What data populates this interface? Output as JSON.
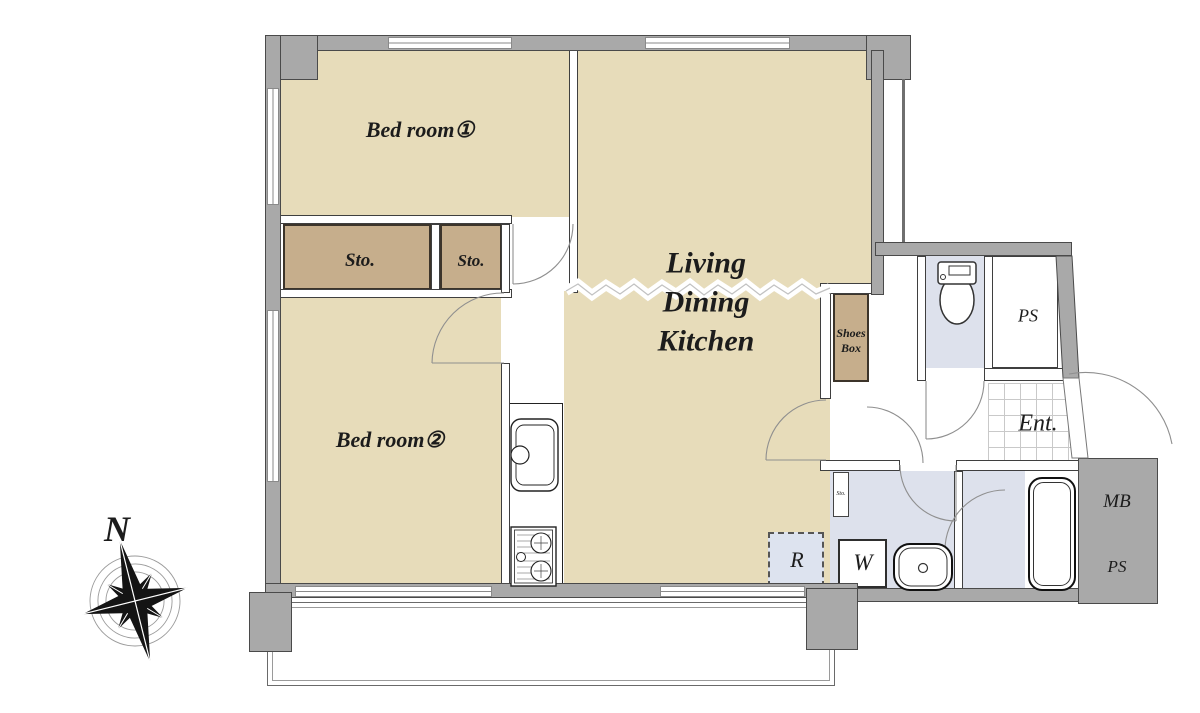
{
  "title": "Apartment floor plan (2LDK)",
  "rooms": {
    "bedroom1": {
      "label": "Bed room①"
    },
    "bedroom2": {
      "label": "Bed room②"
    },
    "ldk": {
      "lines": [
        "Living",
        "Dining",
        "Kitchen"
      ]
    },
    "storage_large": {
      "label": "Sto."
    },
    "storage_small": {
      "label": "Sto."
    },
    "shoes_box": {
      "lines": [
        "Shoes",
        "Box"
      ]
    },
    "ps_top": {
      "label": "PS"
    },
    "entrance": {
      "label": "Ent."
    },
    "meter_box": {
      "label": "MB"
    },
    "ps_bottom": {
      "label": "PS"
    },
    "refrigerator": {
      "label": "R"
    },
    "washing_machine": {
      "label": "W"
    },
    "washroom_storage": {
      "label": "Sto."
    }
  },
  "compass": {
    "north_label": "N"
  },
  "colors": {
    "room_fill": "#e7dcba",
    "closet_fill": "#c6ae8c",
    "wet_area_fill": "#dde1ec",
    "wall_fill": "#a9a9a9",
    "entry_door_lavender": "#dde3ef"
  }
}
